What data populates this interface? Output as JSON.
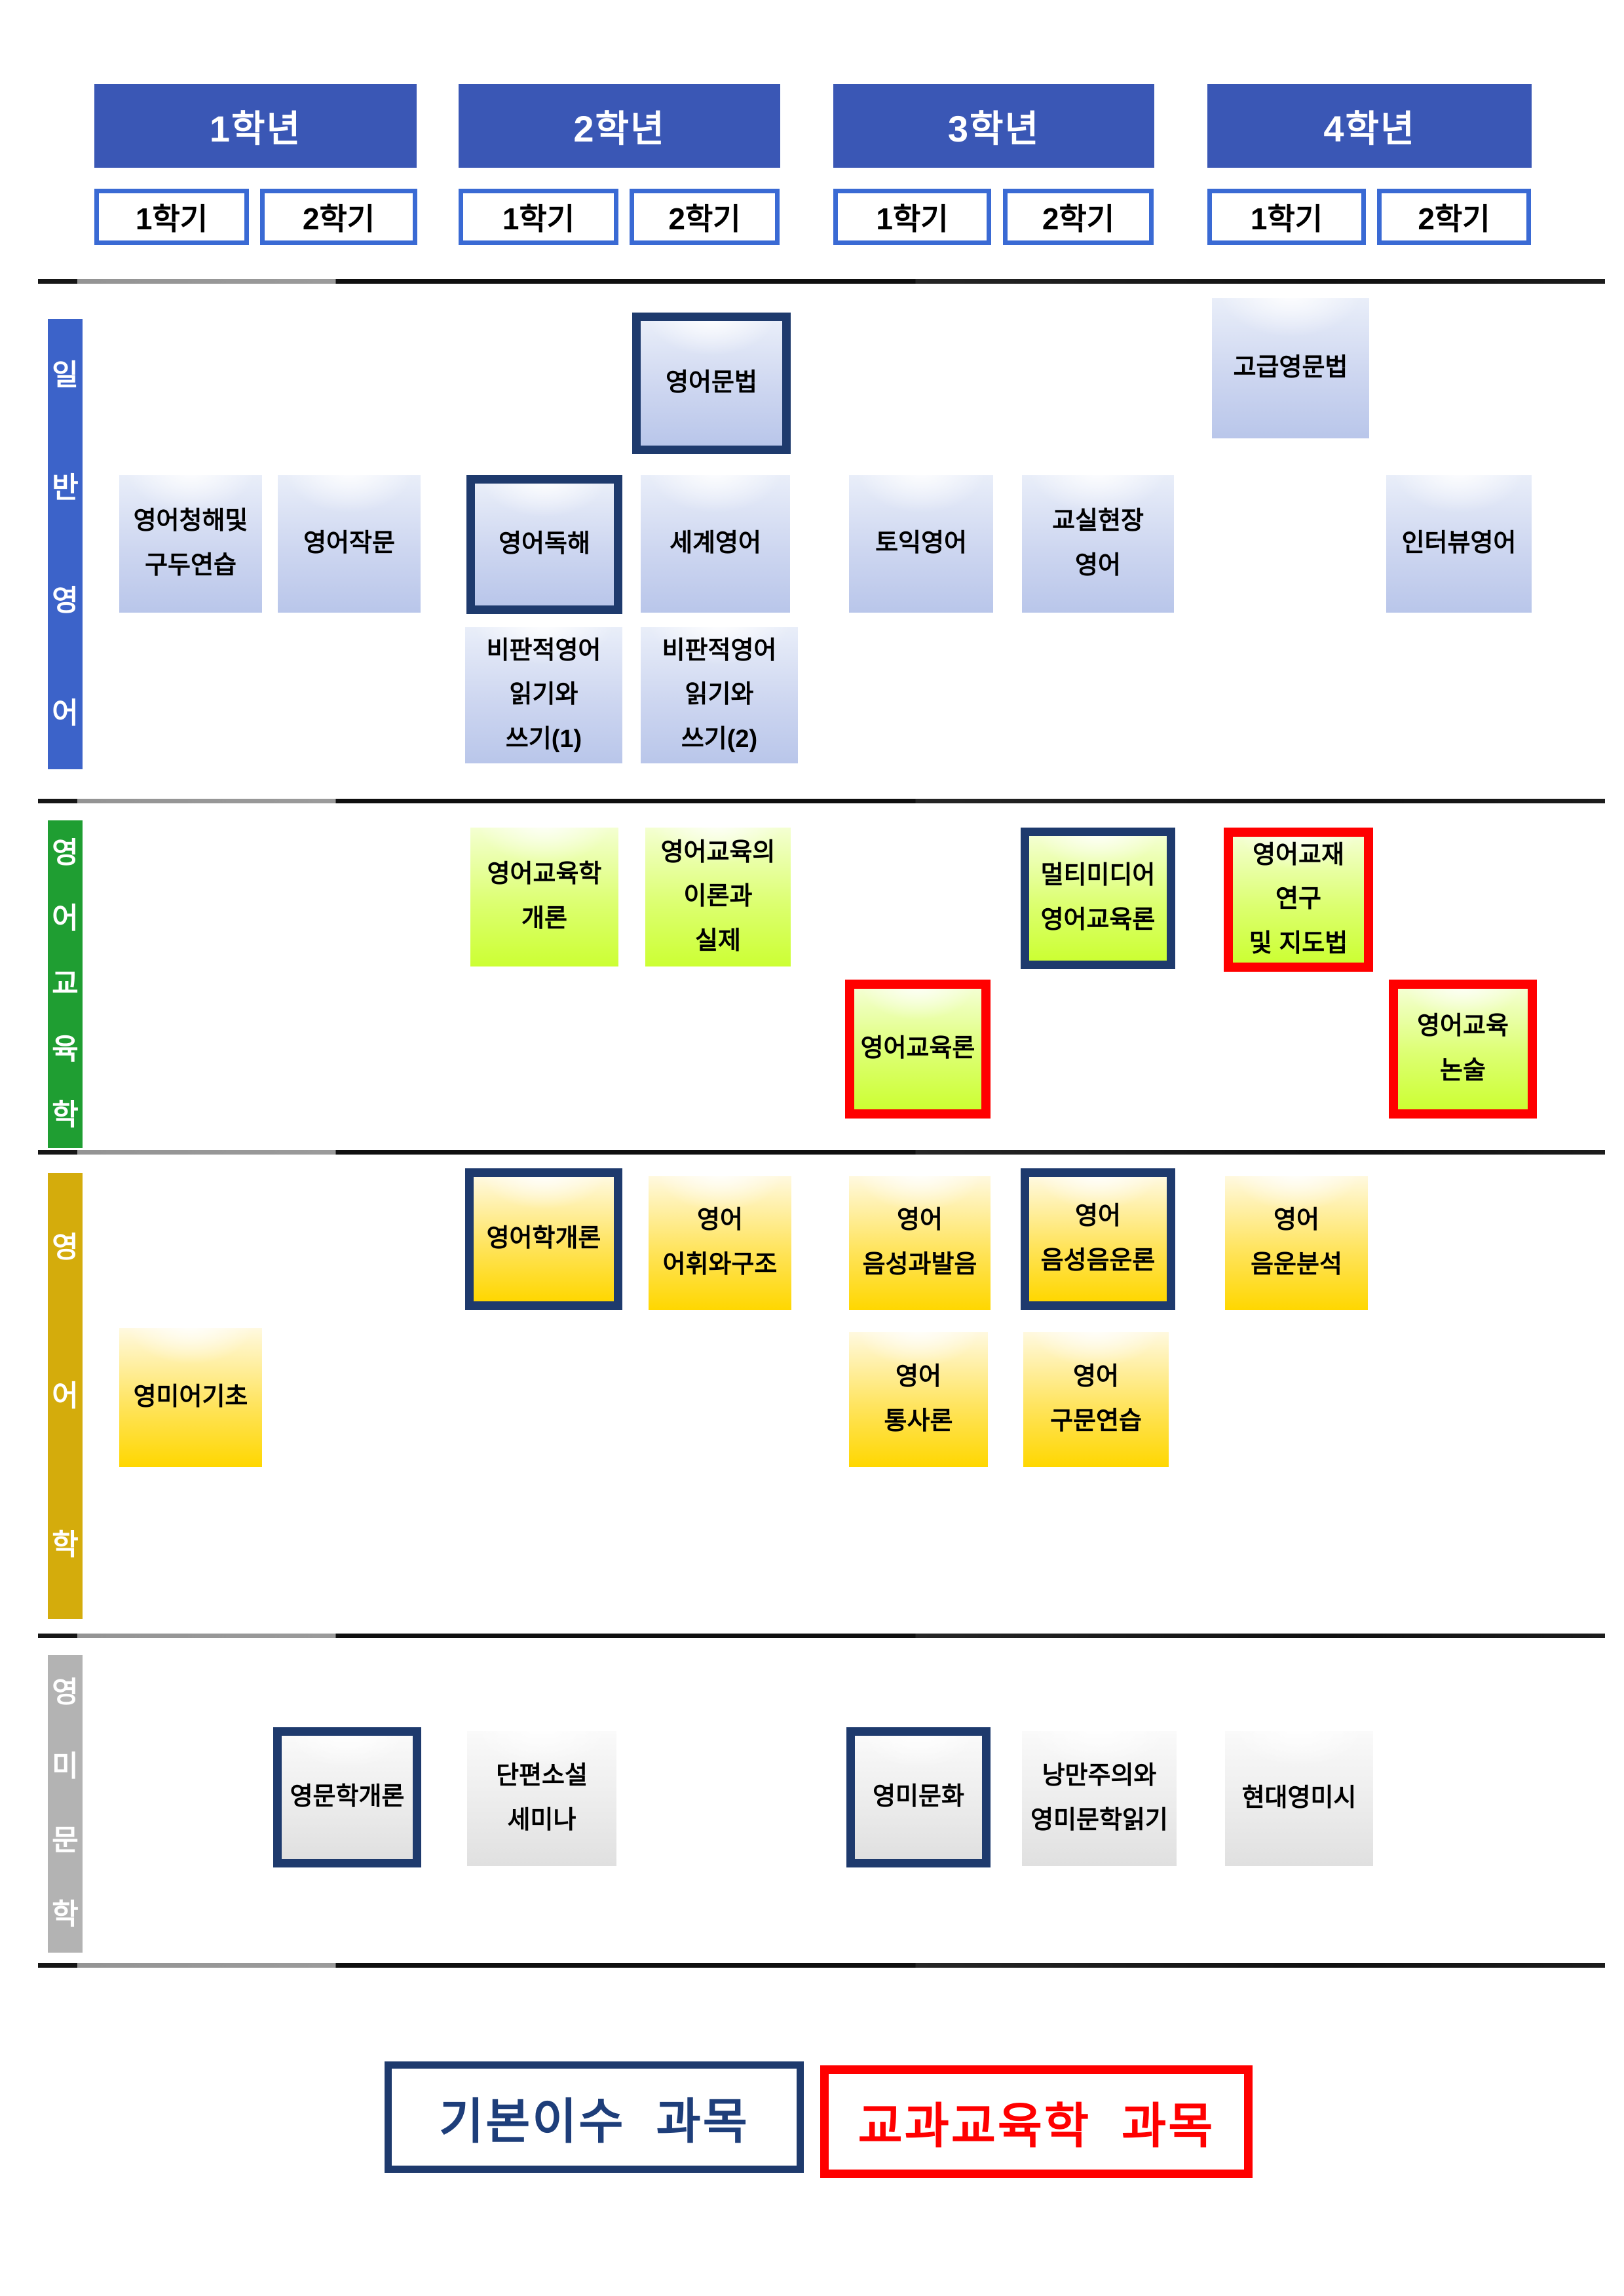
{
  "header": {
    "years": [
      {
        "label": "1학년",
        "sem1": "1학기",
        "sem2": "2학기"
      },
      {
        "label": "2학년",
        "sem1": "1학기",
        "sem2": "2학기"
      },
      {
        "label": "3학년",
        "sem1": "1학기",
        "sem2": "2학기"
      },
      {
        "label": "4학년",
        "sem1": "1학기",
        "sem2": "2학기"
      }
    ]
  },
  "sections": {
    "general": "일반영어",
    "education": "영어교육학",
    "linguistics": "영어학",
    "literature": "영미문학"
  },
  "courses": {
    "listening_oral": "영어청해및\n구두연습",
    "composition": "영어작문",
    "reading": "영어독해",
    "world_english": "세계영어",
    "grammar": "영어문법",
    "critical_rw1": "비판적영어\n읽기와\n쓰기(1)",
    "critical_rw2": "비판적영어\n읽기와\n쓰기(2)",
    "toeic": "토익영어",
    "classroom_english": "교실현장\n영어",
    "advanced_grammar": "고급영문법",
    "interview_english": "인터뷰영어",
    "elt_intro": "영어교육학\n개론",
    "elt_theory_practice": "영어교육의\n이론과\n실제",
    "elt_theory": "영어교육론",
    "multimedia_elt": "멀티미디어\n영어교육론",
    "materials_methods": "영어교재\n연구\n및 지도법",
    "elt_essay": "영어교육\n논술",
    "english_basics": "영미어기초",
    "linguistics_intro": "영어학개론",
    "vocab_structure": "영어\n어휘와구조",
    "phonetics_pron": "영어\n음성과발음",
    "phonetics_phonology": "영어\n음성음운론",
    "phonology_analysis": "영어\n음운분석",
    "syntax": "영어\n통사론",
    "structure_practice": "영어\n구문연습",
    "english_lit_intro": "영문학개론",
    "short_story_seminar": "단편소설\n세미나",
    "british_american_culture": "영미문화",
    "romanticism_reading": "낭만주의와\n영미문학읽기",
    "modern_poetry": "현대영미시"
  },
  "legend": {
    "basic": "기본이수  과목",
    "pedagogy": "교과교육학  과목"
  },
  "colors": {
    "year_header_bg": "#3a57b5",
    "semester_border": "#3a6ad4",
    "general_bar": "#3c63c9",
    "education_bar": "#1f9e32",
    "linguistics_bar": "#d4ac0c",
    "literature_bar": "#b3b3b3",
    "basic_course_border": "#1e3a6d",
    "pedagogy_course_border": "#ff0000",
    "blue_box_bottom": "#b9c6ea",
    "green_box_bottom": "#ccff33",
    "yellow_box_bottom": "#ffd700",
    "gray_box_bottom": "#e0e0e0",
    "legend_basic_text": "#1e3e7a",
    "legend_pedagogy_text": "#ff0000"
  }
}
